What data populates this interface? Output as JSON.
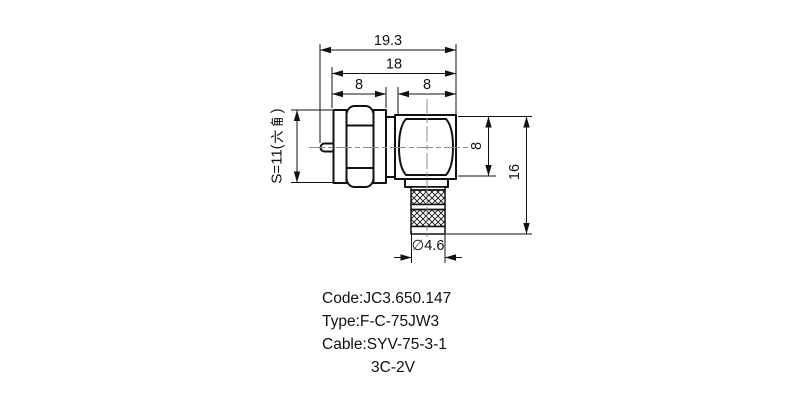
{
  "dimensions": {
    "total_length": "19.3",
    "body_length": "18",
    "hex_section_length": "8",
    "head_width": "8",
    "head_height": "8",
    "total_height": "16",
    "cable_entry_diameter": "∅4.6",
    "wrench_size": {
      "full": "S=11(六角)",
      "prefix": "S=11(",
      "cjk": "六角",
      "suffix": ")"
    }
  },
  "notes": {
    "code": "Code:JC3.650.147",
    "type": "Type:F-C-75JW3",
    "cable": "Cable:SYV-75-3-1",
    "cable2": "3C-2V"
  },
  "colors": {
    "line": "#111111",
    "centerline": "#8c8c8c",
    "background": "#ffffff"
  }
}
